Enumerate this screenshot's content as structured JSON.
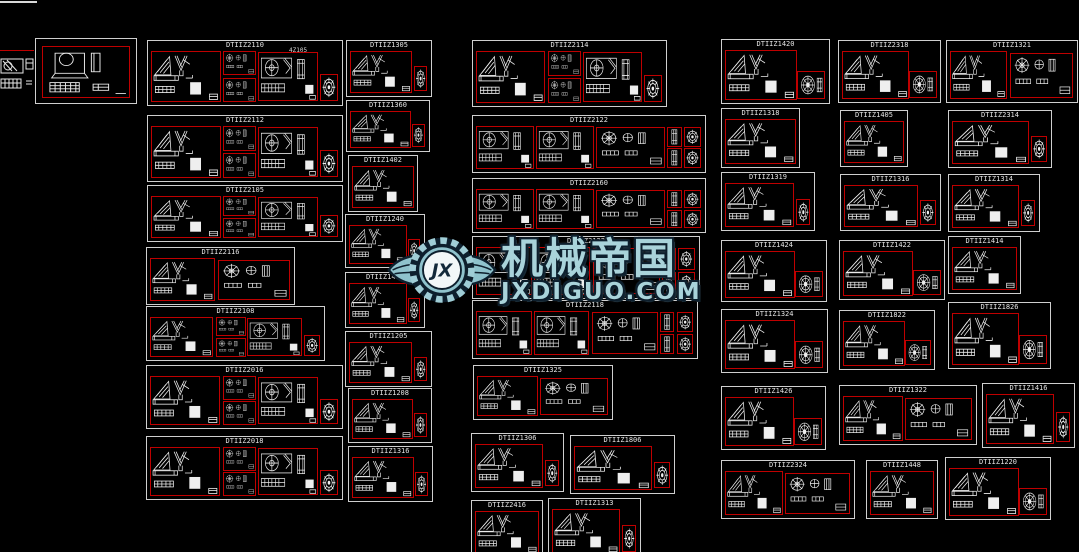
{
  "app": {
    "background": "#000000",
    "sheet_border_color": "#cfcfcf",
    "panel_border_color": "#bf0000",
    "lineart_color": "#eeeeee",
    "title_text_color": "#e3e3e3"
  },
  "watermark": {
    "logo_initials": "JX",
    "brand_cn": "机械帝国",
    "brand_domain": "JXDIGUO.COM",
    "fill_color": "#a9d3da",
    "outline_color": "#0d1f2d"
  },
  "frames": [
    {
      "title": "",
      "x": 35,
      "y": 38,
      "w": 102,
      "h": 66,
      "variant": "frameA"
    },
    {
      "title": "DTIIZ2110",
      "sub": "4Z105",
      "x": 147,
      "y": 40,
      "w": 196,
      "h": 66,
      "variant": "triple"
    },
    {
      "title": "DTIIZ2112",
      "x": 147,
      "y": 115,
      "w": 196,
      "h": 67,
      "variant": "triple"
    },
    {
      "title": "DTIIZ2105",
      "x": 147,
      "y": 185,
      "w": 196,
      "h": 57,
      "variant": "triple"
    },
    {
      "title": "DTIIZ2116",
      "x": 146,
      "y": 247,
      "w": 149,
      "h": 58,
      "variant": "split"
    },
    {
      "title": "DTIIZ2108",
      "x": 146,
      "y": 306,
      "w": 179,
      "h": 55,
      "variant": "triple"
    },
    {
      "title": "DTIIZ2016",
      "x": 146,
      "y": 365,
      "w": 197,
      "h": 64,
      "variant": "triple"
    },
    {
      "title": "DTIIZ2018",
      "x": 146,
      "y": 436,
      "w": 197,
      "h": 64,
      "variant": "triple"
    },
    {
      "title": "DTIIZ1305",
      "x": 346,
      "y": 40,
      "w": 86,
      "h": 57,
      "variant": "single_gear"
    },
    {
      "title": "DTIIZ1360",
      "x": 346,
      "y": 100,
      "w": 84,
      "h": 52,
      "variant": "single_gear"
    },
    {
      "title": "DTIIZ1402",
      "x": 348,
      "y": 155,
      "w": 70,
      "h": 57,
      "variant": "single"
    },
    {
      "title": "DTIIZ1240",
      "x": 345,
      "y": 214,
      "w": 80,
      "h": 54,
      "variant": "single_gear"
    },
    {
      "title": "DTIIZ1430",
      "x": 345,
      "y": 272,
      "w": 80,
      "h": 56,
      "variant": "single_gear"
    },
    {
      "title": "DTIIZ1205",
      "x": 345,
      "y": 331,
      "w": 87,
      "h": 56,
      "variant": "single_gear"
    },
    {
      "title": "DTIIZ1208",
      "x": 348,
      "y": 388,
      "w": 84,
      "h": 55,
      "variant": "single_gear"
    },
    {
      "title": "DTIIZ1316",
      "x": 348,
      "y": 446,
      "w": 85,
      "h": 56,
      "variant": "single_gear"
    },
    {
      "title": "DTIIZ2114",
      "x": 472,
      "y": 40,
      "w": 195,
      "h": 67,
      "variant": "triple"
    },
    {
      "title": "DTIIZ2122",
      "x": 472,
      "y": 115,
      "w": 234,
      "h": 58,
      "variant": "wide"
    },
    {
      "title": "DTIIZ2160",
      "x": 472,
      "y": 178,
      "w": 234,
      "h": 55,
      "variant": "wide"
    },
    {
      "title": "DTIIZ2123",
      "x": 472,
      "y": 236,
      "w": 228,
      "h": 63,
      "variant": "wide"
    },
    {
      "title": "DTIIZ2118",
      "x": 472,
      "y": 300,
      "w": 226,
      "h": 59,
      "variant": "wide"
    },
    {
      "title": "DTIIZ1325",
      "x": 473,
      "y": 365,
      "w": 140,
      "h": 55,
      "variant": "split"
    },
    {
      "title": "DTIIZ1306",
      "x": 471,
      "y": 433,
      "w": 93,
      "h": 59,
      "variant": "single_gear"
    },
    {
      "title": "DTIIZ1806",
      "x": 570,
      "y": 435,
      "w": 105,
      "h": 59,
      "variant": "single_gear"
    },
    {
      "title": "DTIIZ2416",
      "x": 471,
      "y": 500,
      "w": 72,
      "h": 58,
      "variant": "single"
    },
    {
      "title": "DTIIZ1313",
      "x": 548,
      "y": 498,
      "w": 93,
      "h": 60,
      "variant": "single_gear"
    },
    {
      "title": "DTIIZ1420",
      "x": 721,
      "y": 39,
      "w": 109,
      "h": 65,
      "variant": "single_wheel"
    },
    {
      "title": "DTIIZ1318",
      "x": 721,
      "y": 108,
      "w": 79,
      "h": 60,
      "variant": "single"
    },
    {
      "title": "DTIIZ1319",
      "x": 721,
      "y": 172,
      "w": 94,
      "h": 59,
      "variant": "single_gear"
    },
    {
      "title": "DTIIZ1424",
      "x": 721,
      "y": 240,
      "w": 106,
      "h": 62,
      "variant": "single_wheel"
    },
    {
      "title": "DTIIZ1324",
      "x": 721,
      "y": 309,
      "w": 107,
      "h": 64,
      "variant": "single_wheel"
    },
    {
      "title": "DTIIZ1426",
      "x": 721,
      "y": 386,
      "w": 105,
      "h": 64,
      "variant": "single_wheel"
    },
    {
      "title": "DTIIZ2324",
      "x": 721,
      "y": 460,
      "w": 134,
      "h": 59,
      "variant": "split"
    },
    {
      "title": "DTIIZ2318",
      "x": 838,
      "y": 40,
      "w": 103,
      "h": 63,
      "variant": "single_wheel"
    },
    {
      "title": "DTIIZ1405",
      "x": 840,
      "y": 110,
      "w": 68,
      "h": 57,
      "variant": "single"
    },
    {
      "title": "DTIIZ1316",
      "x": 840,
      "y": 174,
      "w": 101,
      "h": 57,
      "variant": "single_gear"
    },
    {
      "title": "DTIIZ1422",
      "x": 839,
      "y": 240,
      "w": 106,
      "h": 60,
      "variant": "single_wheel"
    },
    {
      "title": "DTIIZ1822",
      "x": 839,
      "y": 310,
      "w": 96,
      "h": 60,
      "variant": "single_wheel"
    },
    {
      "title": "DTIIZ1322",
      "x": 839,
      "y": 385,
      "w": 138,
      "h": 60,
      "variant": "split"
    },
    {
      "title": "DTIIZ1448",
      "x": 866,
      "y": 460,
      "w": 72,
      "h": 59,
      "variant": "single"
    },
    {
      "title": "DTIIZ1321",
      "x": 946,
      "y": 40,
      "w": 132,
      "h": 63,
      "variant": "split"
    },
    {
      "title": "DTIIZ2314",
      "x": 948,
      "y": 110,
      "w": 104,
      "h": 58,
      "variant": "single_gear"
    },
    {
      "title": "DTIIZ1314",
      "x": 948,
      "y": 174,
      "w": 92,
      "h": 58,
      "variant": "single_gear"
    },
    {
      "title": "DTIIZ1414",
      "x": 948,
      "y": 236,
      "w": 73,
      "h": 58,
      "variant": "single"
    },
    {
      "title": "DTIIZ1826",
      "x": 948,
      "y": 302,
      "w": 103,
      "h": 67,
      "variant": "single_wheel"
    },
    {
      "title": "DTIIZ1416",
      "x": 982,
      "y": 383,
      "w": 93,
      "h": 65,
      "variant": "single_gear"
    },
    {
      "title": "DTIIZ1220",
      "x": 945,
      "y": 457,
      "w": 106,
      "h": 63,
      "variant": "single_wheel"
    }
  ]
}
